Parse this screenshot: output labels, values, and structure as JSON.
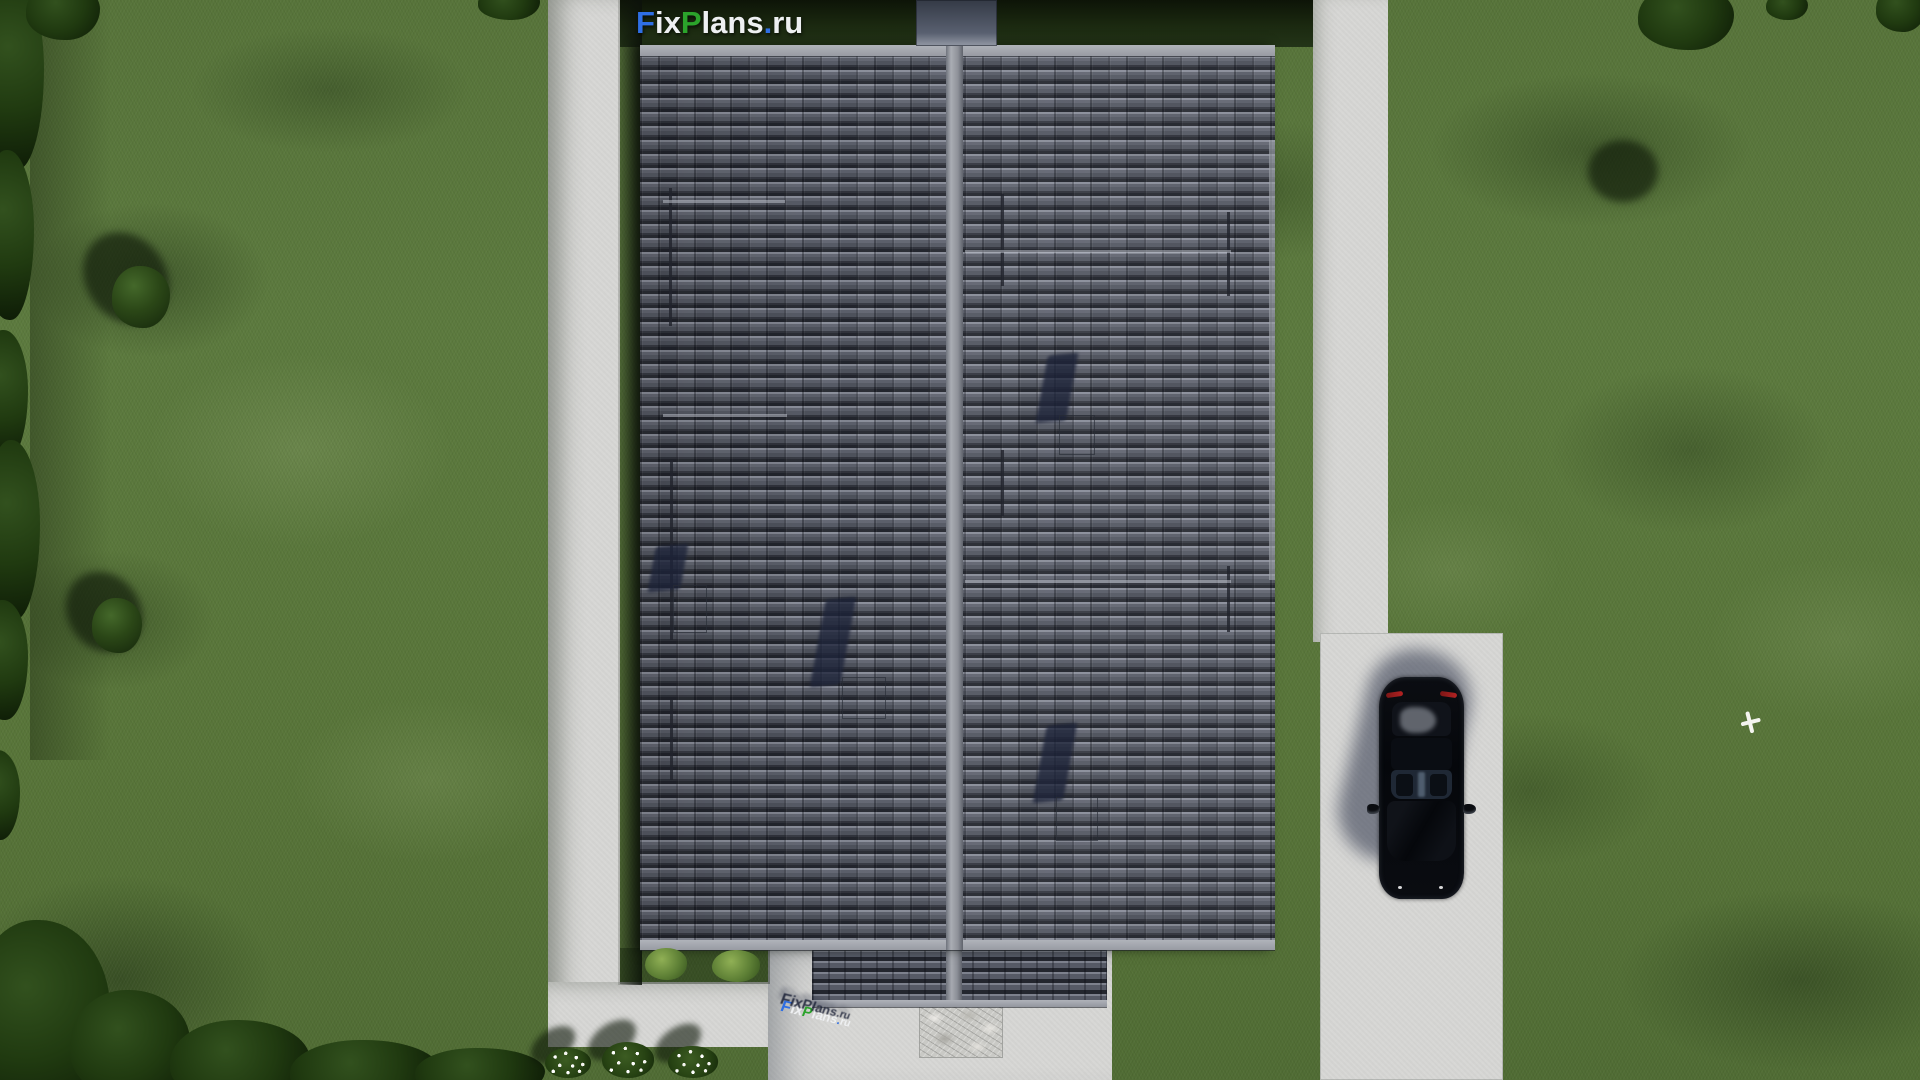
{
  "brand": {
    "name": "FixPlans.ru",
    "letters": [
      {
        "ch": "F",
        "color": "#2f6fe4"
      },
      {
        "ch": "i",
        "color": "#eef0f2"
      },
      {
        "ch": "x",
        "color": "#eef0f2"
      },
      {
        "ch": "P",
        "color": "#2ba32b"
      },
      {
        "ch": "l",
        "color": "#eef0f2"
      },
      {
        "ch": "a",
        "color": "#eef0f2"
      },
      {
        "ch": "n",
        "color": "#eef0f2"
      },
      {
        "ch": "s",
        "color": "#eef0f2"
      },
      {
        "ch": ".",
        "color": "#2f6fe4"
      },
      {
        "ch": "r",
        "color": "#eef0f2"
      },
      {
        "ch": "u",
        "color": "#eef0f2"
      }
    ],
    "accent_blue": "#2f6fe4",
    "accent_green": "#2ba32b",
    "accent_white": "#eef0f2"
  },
  "scene": {
    "colors": {
      "lawn": "#5c7a3e",
      "roof_tiles": "#565a66",
      "roof_fascia": "#a6a9b0",
      "concrete_path": "#d7d7d5",
      "car": "#0a0c10",
      "shadow": "#1c2238"
    },
    "objects": [
      "lawn",
      "hedge-trees",
      "house-roof",
      "garage-roof",
      "roof-ridge",
      "chimney",
      "roof-vents",
      "left-path",
      "right-path",
      "driveway",
      "entrance-apron",
      "stone-paving",
      "car",
      "flower-bushes",
      "bird",
      "watermark-logo",
      "ground-3d-logo"
    ]
  }
}
